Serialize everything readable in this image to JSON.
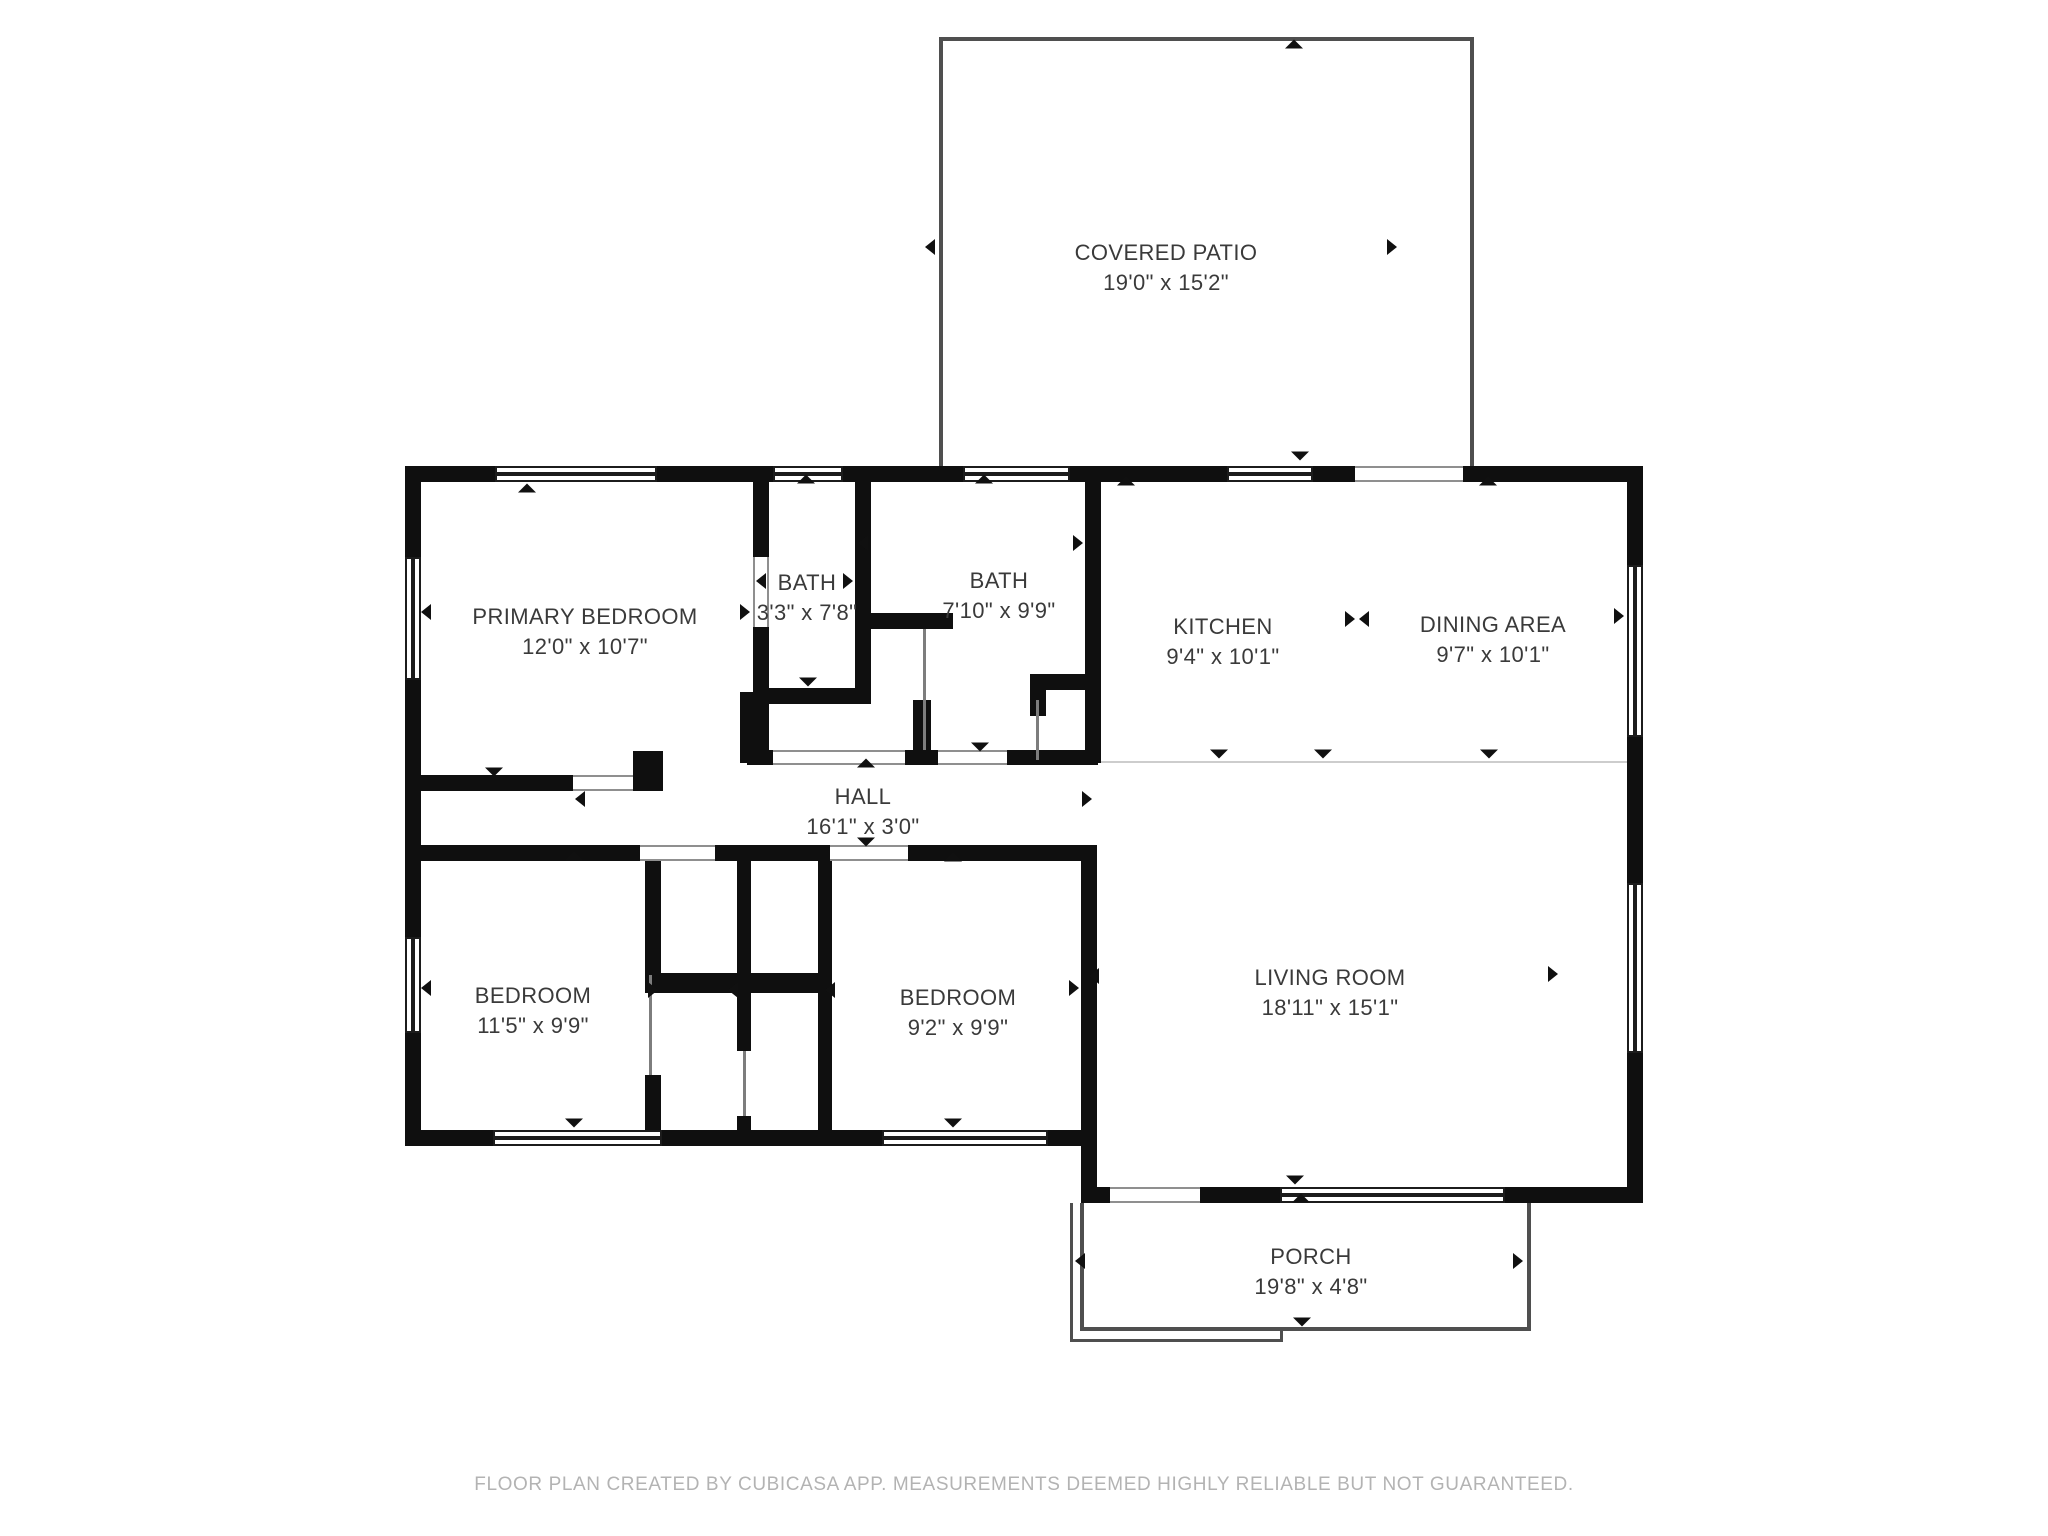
{
  "footer": {
    "text": "FLOOR PLAN CREATED BY CUBICASA APP. MEASUREMENTS DEEMED HIGHLY RELIABLE BUT NOT GUARANTEED."
  },
  "plan": {
    "wall_color": "#0f0f0f",
    "thin_wall_color": "#4f4f4f",
    "label_color": "#3a3a3a",
    "rooms": [
      {
        "name": "COVERED PATIO",
        "dims": "19'0\" x 15'2\"",
        "cx": 1166,
        "cy": 268
      },
      {
        "name": "PRIMARY BEDROOM",
        "dims": "12'0\" x 10'7\"",
        "cx": 585,
        "cy": 632
      },
      {
        "name": "BATH",
        "dims": "3'3\" x 7'8\"",
        "cx": 807,
        "cy": 598
      },
      {
        "name": "BATH",
        "dims": "7'10\" x 9'9\"",
        "cx": 999,
        "cy": 596
      },
      {
        "name": "KITCHEN",
        "dims": "9'4\" x 10'1\"",
        "cx": 1223,
        "cy": 642
      },
      {
        "name": "DINING AREA",
        "dims": "9'7\" x 10'1\"",
        "cx": 1493,
        "cy": 640
      },
      {
        "name": "HALL",
        "dims": "16'1\" x 3'0\"",
        "cx": 863,
        "cy": 812
      },
      {
        "name": "BEDROOM",
        "dims": "11'5\" x 9'9\"",
        "cx": 533,
        "cy": 1011
      },
      {
        "name": "BEDROOM",
        "dims": "9'2\" x 9'9\"",
        "cx": 958,
        "cy": 1013
      },
      {
        "name": "LIVING ROOM",
        "dims": "18'11\" x 15'1\"",
        "cx": 1330,
        "cy": 993
      },
      {
        "name": "PORCH",
        "dims": "19'8\" x 4'8\"",
        "cx": 1311,
        "cy": 1272
      }
    ],
    "walls": [
      [
        405,
        466,
        90,
        16
      ],
      [
        657,
        466,
        116,
        16
      ],
      [
        843,
        466,
        120,
        16
      ],
      [
        1070,
        466,
        157,
        16
      ],
      [
        1313,
        466,
        42,
        16
      ],
      [
        1463,
        466,
        180,
        16
      ],
      [
        405,
        466,
        16,
        91
      ],
      [
        405,
        680,
        16,
        257
      ],
      [
        405,
        1033,
        16,
        113
      ],
      [
        405,
        1130,
        88,
        16
      ],
      [
        662,
        1130,
        220,
        16
      ],
      [
        1048,
        1130,
        49,
        16
      ],
      [
        1081,
        1187,
        29,
        16
      ],
      [
        1200,
        1187,
        80,
        16
      ],
      [
        1505,
        1187,
        138,
        16
      ],
      [
        1627,
        466,
        16,
        99
      ],
      [
        1627,
        737,
        16,
        146
      ],
      [
        1627,
        1053,
        16,
        150
      ],
      [
        753,
        482,
        16,
        75
      ],
      [
        753,
        627,
        16,
        136
      ],
      [
        740,
        692,
        13,
        71
      ],
      [
        855,
        482,
        16,
        222
      ],
      [
        855,
        613,
        98,
        16
      ],
      [
        913,
        700,
        18,
        63
      ],
      [
        753,
        688,
        102,
        16
      ],
      [
        1085,
        482,
        16,
        281
      ],
      [
        1030,
        674,
        71,
        16
      ],
      [
        1030,
        690,
        16,
        26
      ],
      [
        747,
        750,
        26,
        15
      ],
      [
        905,
        750,
        33,
        15
      ],
      [
        1007,
        750,
        91,
        15
      ],
      [
        421,
        775,
        152,
        16
      ],
      [
        633,
        751,
        30,
        40
      ],
      [
        421,
        845,
        219,
        16
      ],
      [
        715,
        845,
        115,
        16
      ],
      [
        908,
        845,
        189,
        16
      ],
      [
        645,
        861,
        16,
        114
      ],
      [
        645,
        1075,
        16,
        57
      ],
      [
        645,
        973,
        187,
        20
      ],
      [
        737,
        861,
        14,
        190
      ],
      [
        737,
        1116,
        14,
        16
      ],
      [
        818,
        861,
        14,
        271
      ],
      [
        1081,
        861,
        16,
        342
      ]
    ],
    "thin_walls": [
      [
        939,
        37,
        535,
        4
      ],
      [
        939,
        37,
        4,
        429
      ],
      [
        1470,
        37,
        4,
        429
      ],
      [
        1080,
        1203,
        4,
        128
      ],
      [
        1080,
        1327,
        451,
        4
      ],
      [
        1527,
        1203,
        4,
        128
      ],
      [
        1070,
        1203,
        3,
        139
      ],
      [
        1070,
        1339,
        213,
        3
      ],
      [
        1280,
        1331,
        3,
        11
      ]
    ],
    "windows": [
      [
        495,
        466,
        162,
        16,
        "h"
      ],
      [
        773,
        466,
        70,
        16,
        "h"
      ],
      [
        963,
        466,
        107,
        16,
        "h"
      ],
      [
        1227,
        466,
        86,
        16,
        "h"
      ],
      [
        405,
        557,
        16,
        123,
        "v"
      ],
      [
        405,
        937,
        16,
        96,
        "v"
      ],
      [
        493,
        1130,
        169,
        16,
        "h"
      ],
      [
        882,
        1130,
        166,
        16,
        "h"
      ],
      [
        1280,
        1187,
        225,
        16,
        "h"
      ],
      [
        1627,
        565,
        16,
        172,
        "v"
      ],
      [
        1627,
        883,
        16,
        170,
        "v"
      ]
    ],
    "openings": [
      [
        1355,
        466,
        108,
        16,
        "h"
      ],
      [
        1110,
        1187,
        90,
        16,
        "h"
      ],
      [
        753,
        557,
        16,
        70,
        "v"
      ],
      [
        773,
        750,
        132,
        15,
        "h"
      ],
      [
        938,
        750,
        69,
        15,
        "h"
      ],
      [
        573,
        775,
        60,
        16,
        "h"
      ],
      [
        640,
        845,
        75,
        16,
        "h"
      ],
      [
        830,
        845,
        78,
        16,
        "h"
      ]
    ],
    "door_lines": [
      [
        923,
        629,
        3,
        121
      ],
      [
        649,
        975,
        3,
        100
      ],
      [
        743,
        1051,
        3,
        65
      ],
      [
        1036,
        700,
        3,
        60
      ]
    ],
    "zone_lines": [
      [
        1101,
        761,
        526,
        2
      ]
    ],
    "arrows": [
      {
        "dir": "up",
        "x": 1294,
        "y": 44
      },
      {
        "dir": "down",
        "x": 1300,
        "y": 456
      },
      {
        "dir": "left",
        "x": 930,
        "y": 247
      },
      {
        "dir": "right",
        "x": 1392,
        "y": 247
      },
      {
        "dir": "up",
        "x": 527,
        "y": 488
      },
      {
        "dir": "left",
        "x": 426,
        "y": 612
      },
      {
        "dir": "right",
        "x": 745,
        "y": 612
      },
      {
        "dir": "down",
        "x": 494,
        "y": 772
      },
      {
        "dir": "left",
        "x": 761,
        "y": 581
      },
      {
        "dir": "right",
        "x": 848,
        "y": 581
      },
      {
        "dir": "up",
        "x": 806,
        "y": 479
      },
      {
        "dir": "down",
        "x": 808,
        "y": 682
      },
      {
        "dir": "left",
        "x": 863,
        "y": 543
      },
      {
        "dir": "right",
        "x": 1078,
        "y": 543
      },
      {
        "dir": "up",
        "x": 984,
        "y": 479
      },
      {
        "dir": "down",
        "x": 980,
        "y": 747
      },
      {
        "dir": "up",
        "x": 1126,
        "y": 481
      },
      {
        "dir": "down",
        "x": 1219,
        "y": 754
      },
      {
        "dir": "down",
        "x": 1323,
        "y": 754
      },
      {
        "dir": "down",
        "x": 1489,
        "y": 754
      },
      {
        "dir": "up",
        "x": 1488,
        "y": 481
      },
      {
        "dir": "right",
        "x": 1619,
        "y": 616
      },
      {
        "dir": "right",
        "x": 1350,
        "y": 619
      },
      {
        "dir": "left",
        "x": 1364,
        "y": 619
      },
      {
        "dir": "left",
        "x": 580,
        "y": 799
      },
      {
        "dir": "right",
        "x": 1087,
        "y": 799
      },
      {
        "dir": "up",
        "x": 866,
        "y": 763
      },
      {
        "dir": "down",
        "x": 866,
        "y": 842
      },
      {
        "dir": "up",
        "x": 574,
        "y": 856
      },
      {
        "dir": "left",
        "x": 426,
        "y": 988
      },
      {
        "dir": "down",
        "x": 574,
        "y": 1123
      },
      {
        "dir": "right",
        "x": 653,
        "y": 990
      },
      {
        "dir": "left",
        "x": 733,
        "y": 990
      },
      {
        "dir": "left",
        "x": 830,
        "y": 990
      },
      {
        "dir": "up",
        "x": 953,
        "y": 857
      },
      {
        "dir": "right",
        "x": 1074,
        "y": 988
      },
      {
        "dir": "down",
        "x": 953,
        "y": 1123
      },
      {
        "dir": "left",
        "x": 1094,
        "y": 976
      },
      {
        "dir": "right",
        "x": 1553,
        "y": 974
      },
      {
        "dir": "down",
        "x": 1295,
        "y": 1180
      },
      {
        "dir": "up",
        "x": 1301,
        "y": 1198
      },
      {
        "dir": "left",
        "x": 1080,
        "y": 1261
      },
      {
        "dir": "right",
        "x": 1518,
        "y": 1261
      },
      {
        "dir": "down",
        "x": 1302,
        "y": 1322
      }
    ]
  }
}
